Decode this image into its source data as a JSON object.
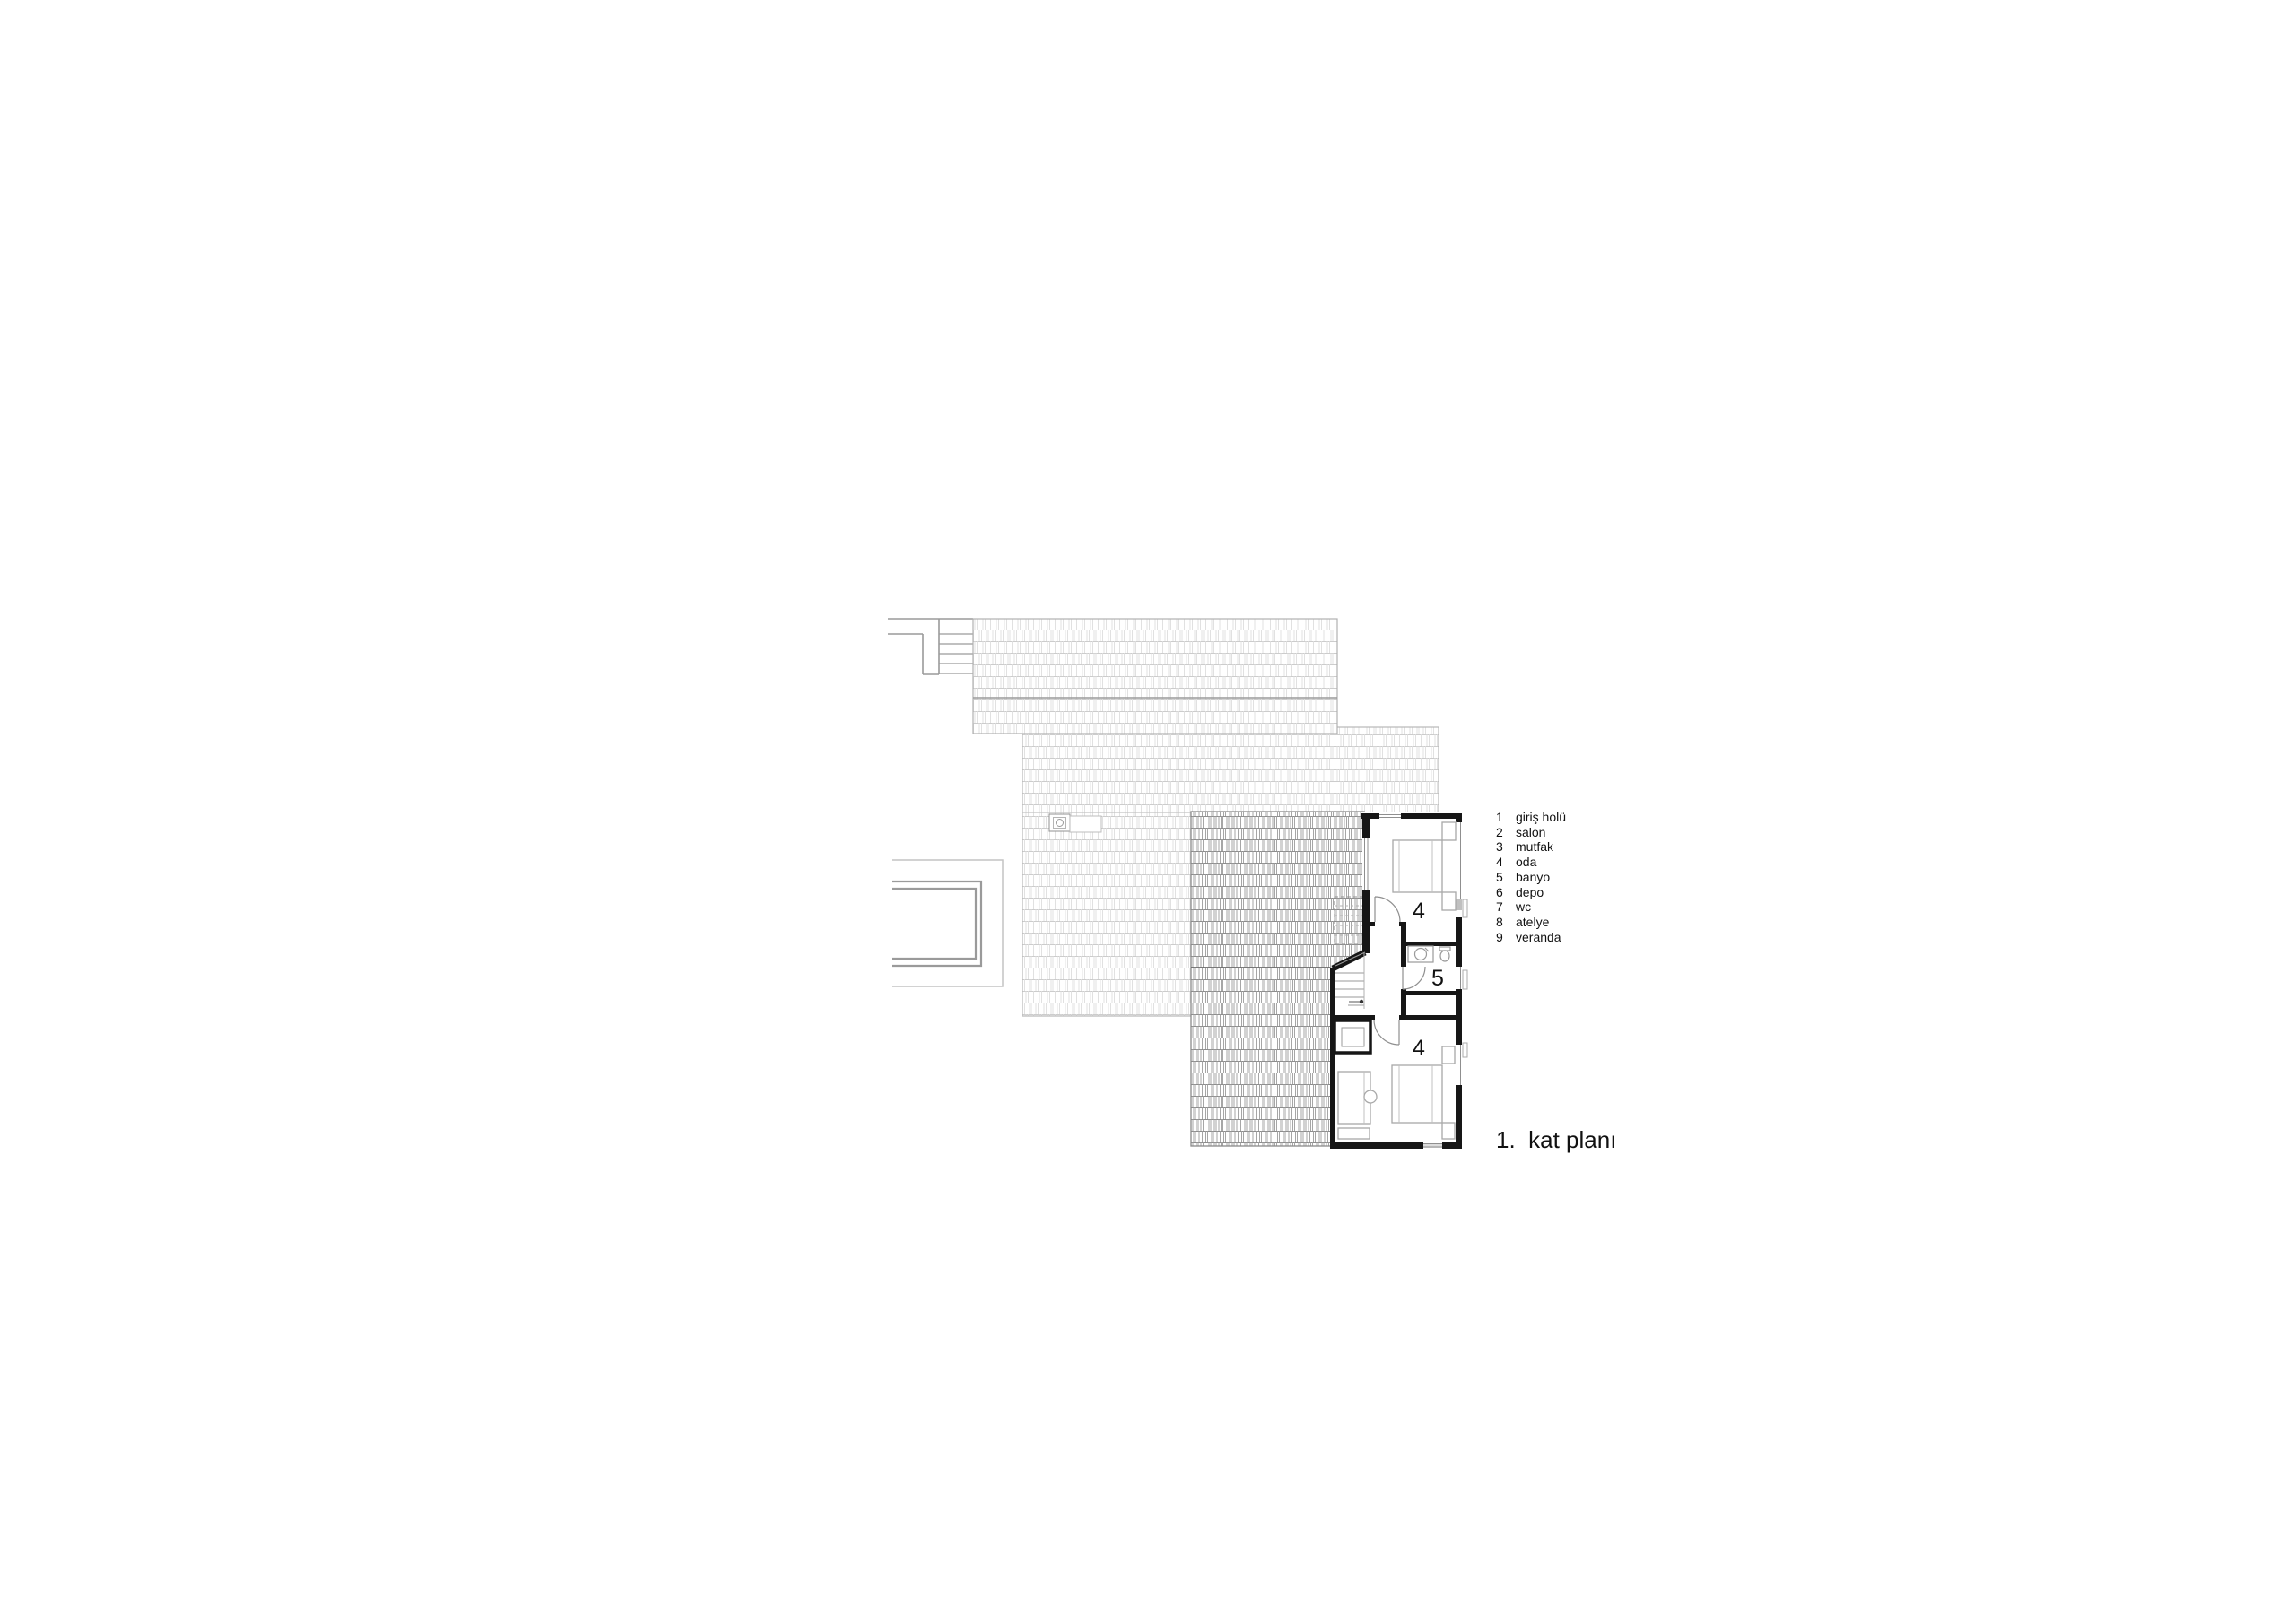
{
  "drawing": {
    "kind": "architectural floor plan",
    "title": "1.  kat planı",
    "room_labels": [
      {
        "id": "room-4-top",
        "text": "4"
      },
      {
        "id": "room-5-bath",
        "text": "5"
      },
      {
        "id": "room-4-bottom",
        "text": "4"
      }
    ],
    "legend": {
      "items": [
        {
          "num": "1",
          "label": "giriş holü"
        },
        {
          "num": "2",
          "label": "salon"
        },
        {
          "num": "3",
          "label": "mutfak"
        },
        {
          "num": "4",
          "label": "oda"
        },
        {
          "num": "5",
          "label": "banyo"
        },
        {
          "num": "6",
          "label": "depo"
        },
        {
          "num": "7",
          "label": "wc"
        },
        {
          "num": "8",
          "label": "atelye"
        },
        {
          "num": "9",
          "label": "veranda"
        }
      ]
    },
    "colors": {
      "background": "#ffffff",
      "wall": "#161616",
      "roof_tile_light": "#d9d9d9",
      "roof_tile_dark": "#909090",
      "thin_line_gray": "#9a9a9a",
      "text": "#111111"
    }
  }
}
